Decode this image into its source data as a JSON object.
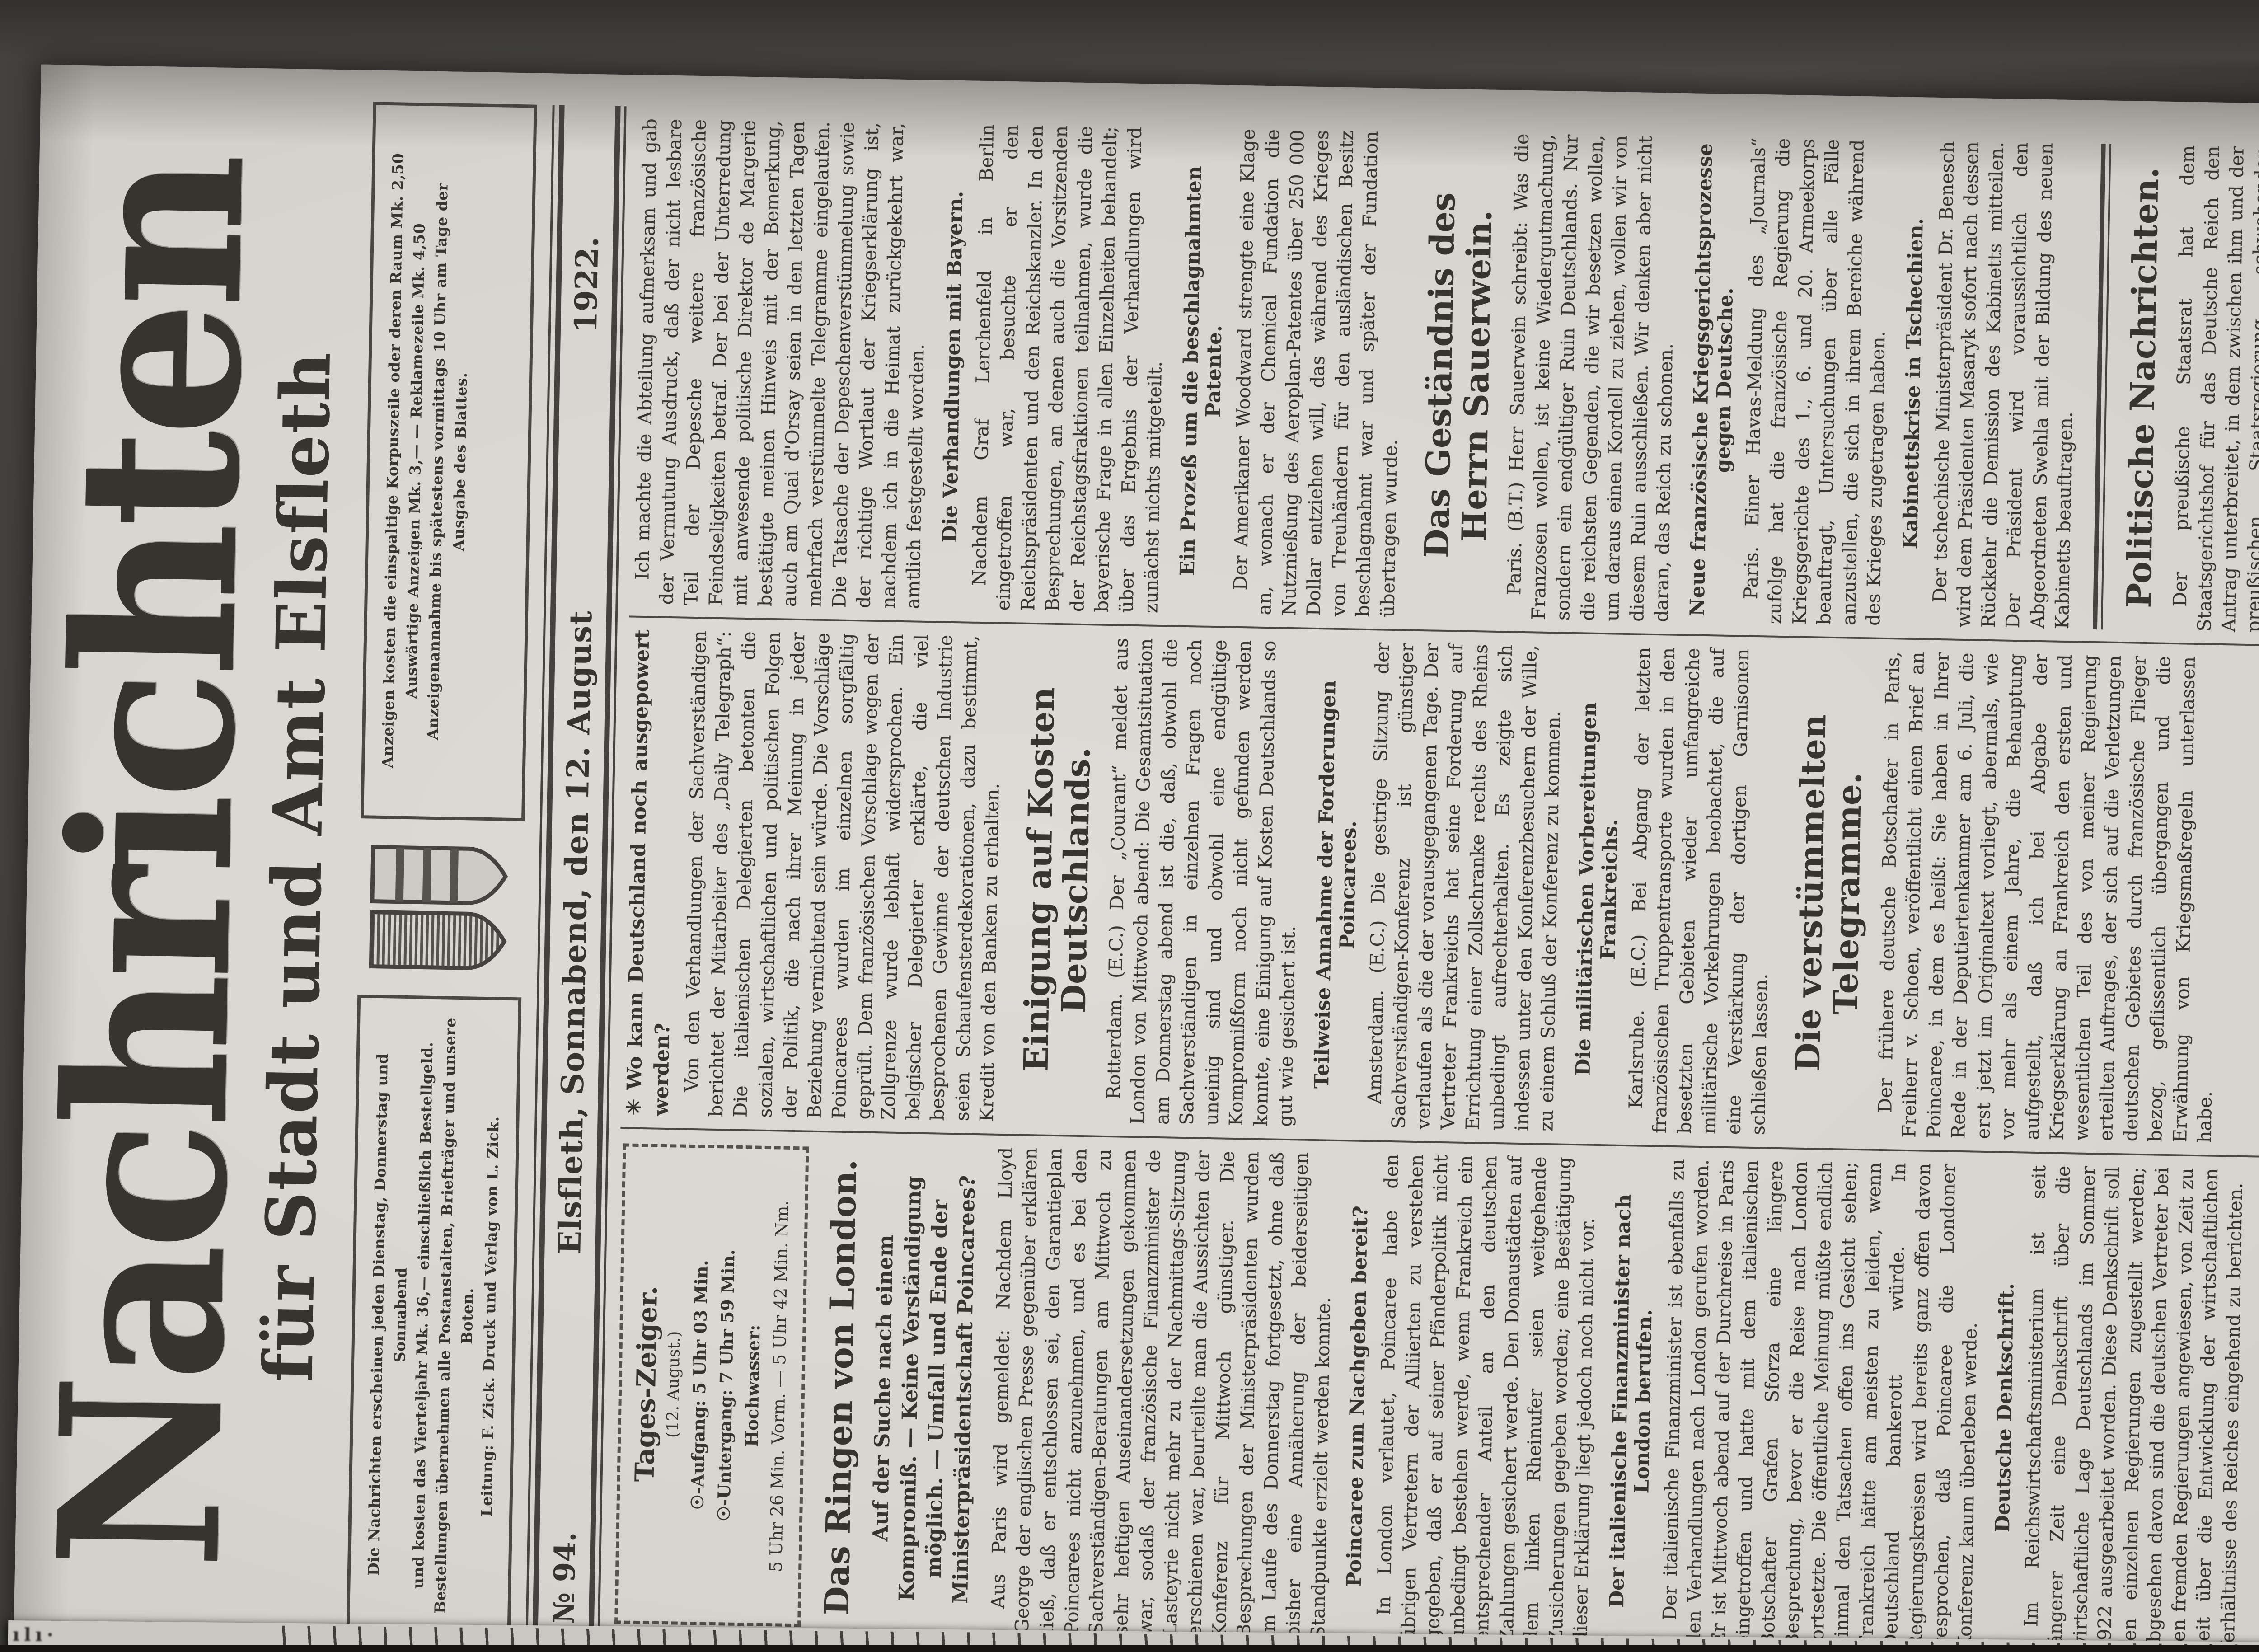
{
  "masthead": {
    "title": "Nachrichten",
    "subtitle": "für Stadt und Amt Elsfleth"
  },
  "info_left": {
    "line1": "Die Nachrichten erscheinen jeden Dienstag, Donnerstag und Sonnabend",
    "line2": "und kosten das Vierteljahr Mk. 36,— einschließlich Bestellgeld.",
    "line3": "Bestellungen übernehmen alle Postanstalten, Briefträger und unsere Boten.",
    "line4": "Leitung: F. Zick.  Druck und Verlag von L. Zick."
  },
  "info_right": {
    "line1": "Anzeigen kosten die einspaltige Korpuszeile oder deren Raum Mk. 2,50",
    "line2": "Auswärtige Anzeigen Mk. 3,— — Reklamezeile Mk. 4,50",
    "line3": "Anzeigenannahme bis spätestens vormittags 10 Uhr am Tage der",
    "line4": "Ausgabe des Blattes."
  },
  "dateline": {
    "issue": "№ 94.",
    "place_date": "Elsfleth, Sonnabend, den 12. August",
    "year": "1922."
  },
  "tages_zeiger": {
    "title": "Tages-Zeiger.",
    "date": "(12. August.)",
    "sunrise": "☉-Aufgang: 5 Uhr 03 Min.",
    "sunset": "☉-Untergang: 7 Uhr 59 Min.",
    "tide_label": "Hochwasser:",
    "tide": "5 Uhr 26 Min. Vorm. — 5 Uhr 42 Min. Nm."
  },
  "columns": [
    {
      "blocks": [
        {
          "type": "tzbox"
        },
        {
          "type": "headline",
          "text": "Das Ringen von London."
        },
        {
          "type": "deck",
          "text": "Auf der Suche nach einem Kompromiß. — Keine Verständigung möglich. — Umfall und Ende der Ministerpräsidentschaft Poincarees?"
        },
        {
          "type": "para",
          "text": "Aus Paris wird gemeldet: Nachdem Lloyd George der englischen Presse gegenüber erklären ließ, daß er entschlossen sei, den Garantieplan Poincarees nicht anzunehmen, und es bei den Sachverständigen-Beratungen am Mittwoch zu sehr heftigen Auseinandersetzungen gekommen war, sodaß der französische Finanzminister de Lasteyrie nicht mehr zu der Nachmittags-Sitzung erschienen war, beurteilte man die Aussichten der Konferenz für Mittwoch günstiger. Die Besprechungen der Ministerpräsidenten wurden im Laufe des Donnerstag fortgesetzt, ohne daß bisher eine Annäherung der beiderseitigen Standpunkte erzielt werden konnte."
        },
        {
          "type": "subhead",
          "text": "Poincaree zum Nachgeben bereit?"
        },
        {
          "type": "para",
          "text": "In London verlautet, Poincaree habe den übrigen Vertretern der Alliierten zu verstehen gegeben, daß er auf seiner Pfänderpolitik nicht unbedingt bestehen werde, wenn Frankreich ein entsprechender Anteil an den deutschen Zahlungen gesichert werde. Den Donaustädten auf dem linken Rheinufer seien weitgehende Zusicherungen gegeben worden; eine Bestätigung dieser Erklärung liegt jedoch noch nicht vor."
        },
        {
          "type": "subhead",
          "text": "Der italienische Finanzminister nach London berufen."
        },
        {
          "type": "para",
          "text": "Der italienische Finanzminister ist ebenfalls zu den Verhandlungen nach London gerufen worden. Er ist Mittwoch abend auf der Durchreise in Paris eingetroffen und hatte mit dem italienischen Botschafter Grafen Sforza eine längere Besprechung, bevor er die Reise nach London fortsetzte. Die öffentliche Meinung müßte endlich einmal den Tatsachen offen ins Gesicht sehen; Frankreich hätte am meisten zu leiden, wenn Deutschland bankerott würde. In Regierungskreisen wird bereits ganz offen davon gesprochen, daß Poincaree die Londoner Konferenz kaum überleben werde."
        },
        {
          "type": "subhead",
          "text": "Deutsche Denkschrift."
        },
        {
          "type": "para",
          "text": "Im Reichswirtschaftsministerium ist seit längerer Zeit eine Denkschrift über die wirtschaftliche Lage Deutschlands im Sommer 1922 ausgearbeitet worden. Diese Denkschrift soll den einzelnen Regierungen zugestellt werden; abgesehen davon sind die deutschen Vertreter bei den fremden Regierungen angewiesen, von Zeit zu Zeit über die Entwicklung der wirtschaftlichen Verhältnisse des Reiches eingehend zu berichten."
        }
      ]
    },
    {
      "blocks": [
        {
          "type": "lead",
          "text": "✳ Wo kann Deutschland noch ausgepowert werden?"
        },
        {
          "type": "para",
          "text": "Von den Verhandlungen der Sachverständigen berichtet der Mitarbeiter des „Daily Telegraph“: Die italienischen Delegierten betonten die sozialen, wirtschaftlichen und politischen Folgen der Politik, die nach ihrer Meinung in jeder Beziehung vernichtend sein würde. Die Vorschläge Poincarees wurden im einzelnen sorgfältig geprüft. Dem französischen Vorschlage wegen der Zollgrenze wurde lebhaft widersprochen. Ein belgischer Delegierter erklärte, die viel besprochenen Gewinne der deutschen Industrie seien Schaufensterdekorationen, dazu bestimmt, Kredit von den Banken zu erhalten."
        },
        {
          "type": "headline",
          "text": "Einigung auf Kosten Deutschlands."
        },
        {
          "type": "para",
          "text": "Rotterdam. (E.C.) Der „Courant“ meldet aus London von Mittwoch abend: Die Gesamtsituation am Donnerstag abend ist die, daß, obwohl die Sachverständigen in einzelnen Fragen noch uneinig sind und obwohl eine endgültige Kompromißform noch nicht gefunden werden konnte, eine Einigung auf Kosten Deutschlands so gut wie gesichert ist."
        },
        {
          "type": "subhead",
          "text": "Teilweise Annahme der Forderungen Poincarees."
        },
        {
          "type": "para",
          "text": "Amsterdam. (E.C.) Die gestrige Sitzung der Sachverständigen-Konferenz ist günstiger verlaufen als die der vorausgegangenen Tage. Der Vertreter Frankreichs hat seine Forderung auf Errichtung einer Zollschranke rechts des Rheins unbedingt aufrechterhalten. Es zeigte sich indessen unter den Konferenzbesuchern der Wille, zu einem Schluß der Konferenz zu kommen."
        },
        {
          "type": "subhead",
          "text": "Die militärischen Vorbereitungen Frankreichs."
        },
        {
          "type": "para",
          "text": "Karlsruhe. (E.C.) Bei Abgang der letzten französischen Truppentransporte wurden in den besetzten Gebieten wieder umfangreiche militärische Vorkehrungen beobachtet, die auf eine Verstärkung der dortigen Garnisonen schließen lassen."
        },
        {
          "type": "headline",
          "text": "Die verstümmelten Telegramme."
        },
        {
          "type": "para",
          "text": "Der frühere deutsche Botschafter in Paris, Freiherr v. Schoen, veröffentlicht einen Brief an Poincaree, in dem es heißt: Sie haben in Ihrer Rede in der Deputiertenkammer am 6. Juli, die erst jetzt im Originaltext vorliegt, abermals, wie vor mehr als einem Jahre, die Behauptung aufgestellt, daß ich bei Abgabe der Kriegserklärung an Frankreich den ersten und wesentlichen Teil des von meiner Regierung erteilten Auftrages, der sich auf die Verletzungen deutschen Gebietes durch französische Flieger bezog, geflissentlich übergangen und die Erwähnung von Kriegsmaßregeln unterlassen habe."
        }
      ]
    },
    {
      "blocks": [
        {
          "type": "para",
          "text": "Ich machte die Abteilung aufmerksam und gab der Vermutung Ausdruck, daß der nicht lesbare Teil der Depesche weitere französische Feindseligkeiten betraf. Der bei der Unterredung mit anwesende politische Direktor de Margerie bestätigte meinen Hinweis mit der Bemerkung, auch am Quai d'Orsay seien in den letzten Tagen mehrfach verstümmelte Telegramme eingelaufen. Die Tatsache der Depeschenverstümmelung sowie der richtige Wortlaut der Kriegserklärung ist, nachdem ich in die Heimat zurückgekehrt war, amtlich festgestellt worden."
        },
        {
          "type": "subhead",
          "text": "Die Verhandlungen mit Bayern."
        },
        {
          "type": "para",
          "text": "Nachdem Graf Lerchenfeld in Berlin eingetroffen war, besuchte er den Reichspräsidenten und den Reichskanzler. In den Besprechungen, an denen auch die Vorsitzenden der Reichstagsfraktionen teilnahmen, wurde die bayerische Frage in allen Einzelheiten behandelt; über das Ergebnis der Verhandlungen wird zunächst nichts mitgeteilt."
        },
        {
          "type": "subhead",
          "text": "Ein Prozeß um die beschlagnahmten Patente."
        },
        {
          "type": "para",
          "text": "Der Amerikaner Woodward strengte eine Klage an, wonach er der Chemical Fundation die Nutznießung des Aeroplan-Patentes über 250 000 Dollar entziehen will, das während des Krieges von Treuhändern für den ausländischen Besitz beschlagnahmt war und später der Fundation übertragen wurde."
        },
        {
          "type": "headline",
          "text": "Das Geständnis des Herrn Sauerwein."
        },
        {
          "type": "para",
          "text": "Paris. (B.T.) Herr Sauerwein schreibt: Was die Franzosen wollen, ist keine Wiedergutmachung, sondern ein endgültiger Ruin Deutschlands. Nur die reichsten Gegenden, die wir besetzen wollen, um daraus einen Kordell zu ziehen, wollen wir von diesem Ruin ausschließen. Wir denken aber nicht daran, das Reich zu schonen."
        },
        {
          "type": "subhead",
          "text": "Neue französische Kriegsgerichtsprozesse gegen Deutsche."
        },
        {
          "type": "para",
          "text": "Paris. Einer Havas-Meldung des „Journals“ zufolge hat die französische Regierung die Kriegsgerichte des 1., 6. und 20. Armeekorps beauftragt, Untersuchungen über alle Fälle anzustellen, die sich in ihrem Bereiche während des Krieges zugetragen haben."
        },
        {
          "type": "subhead",
          "text": "Kabinettskrise in Tschechien."
        },
        {
          "type": "para",
          "text": "Der tschechische Ministerpräsident Dr. Benesch wird dem Präsidenten Masaryk sofort nach dessen Rückkehr die Demission des Kabinetts mitteilen. Der Präsident wird voraussichtlich den Abgeordneten Swehla mit der Bildung des neuen Kabinetts beauftragen."
        },
        {
          "type": "rule"
        },
        {
          "type": "headline",
          "text": "Politische Nachrichten."
        },
        {
          "type": "para",
          "text": "Der preußische Staatsrat hat dem Staatsgerichtshof für das Deutsche Reich den Antrag unterbreitet, in dem zwischen ihm und der preußischen Staatsregierung schwebenden Streitverfahren alsbald eine Entscheidung herbeizuführen."
        }
      ]
    }
  ],
  "edge_text": "ılı·"
}
